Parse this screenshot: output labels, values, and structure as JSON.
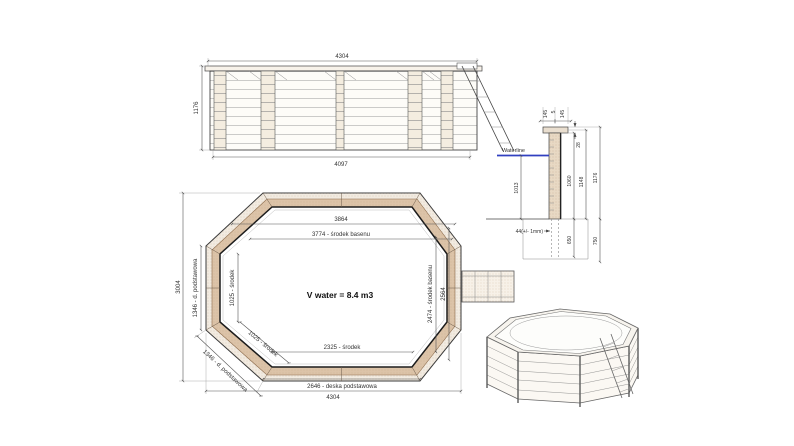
{
  "side_elevation": {
    "dim_top": "4304",
    "dim_left": "1176",
    "dim_bottom": "4097"
  },
  "cross_section": {
    "coping_left": "145",
    "coping_gap": "5",
    "coping_right": "145",
    "coping_thickness": "28",
    "waterline_label": "Waterline",
    "water_depth": "1013",
    "height_inner": "1060",
    "height_wall": "1148",
    "height_total": "1176",
    "wall_thickness": "44(+/- 1mm)",
    "buried_inner": "650",
    "buried_outer": "750"
  },
  "plan": {
    "volume": "V water = 8.4 m3",
    "width_inner_top": "3864",
    "width_pool_center": "3774 - środek basenu",
    "width_bottom_center": "2325 - środek",
    "width_base_board": "2646 - deska podstawowa",
    "width_total": "4304",
    "height_total": "3004",
    "left_base_board": "1346 - d. podstawowa",
    "left_center": "1025 - środek",
    "diag_center": "1025 - środek",
    "diag_base_board": "1346 - d. podstawowa",
    "right_pool_center": "2474 - środek basenu",
    "right_inner": "2564"
  },
  "colors": {
    "waterline_blue": "#3140c0",
    "wood_band": "#dcc3a8",
    "wood_light": "#f2ebe1",
    "line": "#444444"
  }
}
